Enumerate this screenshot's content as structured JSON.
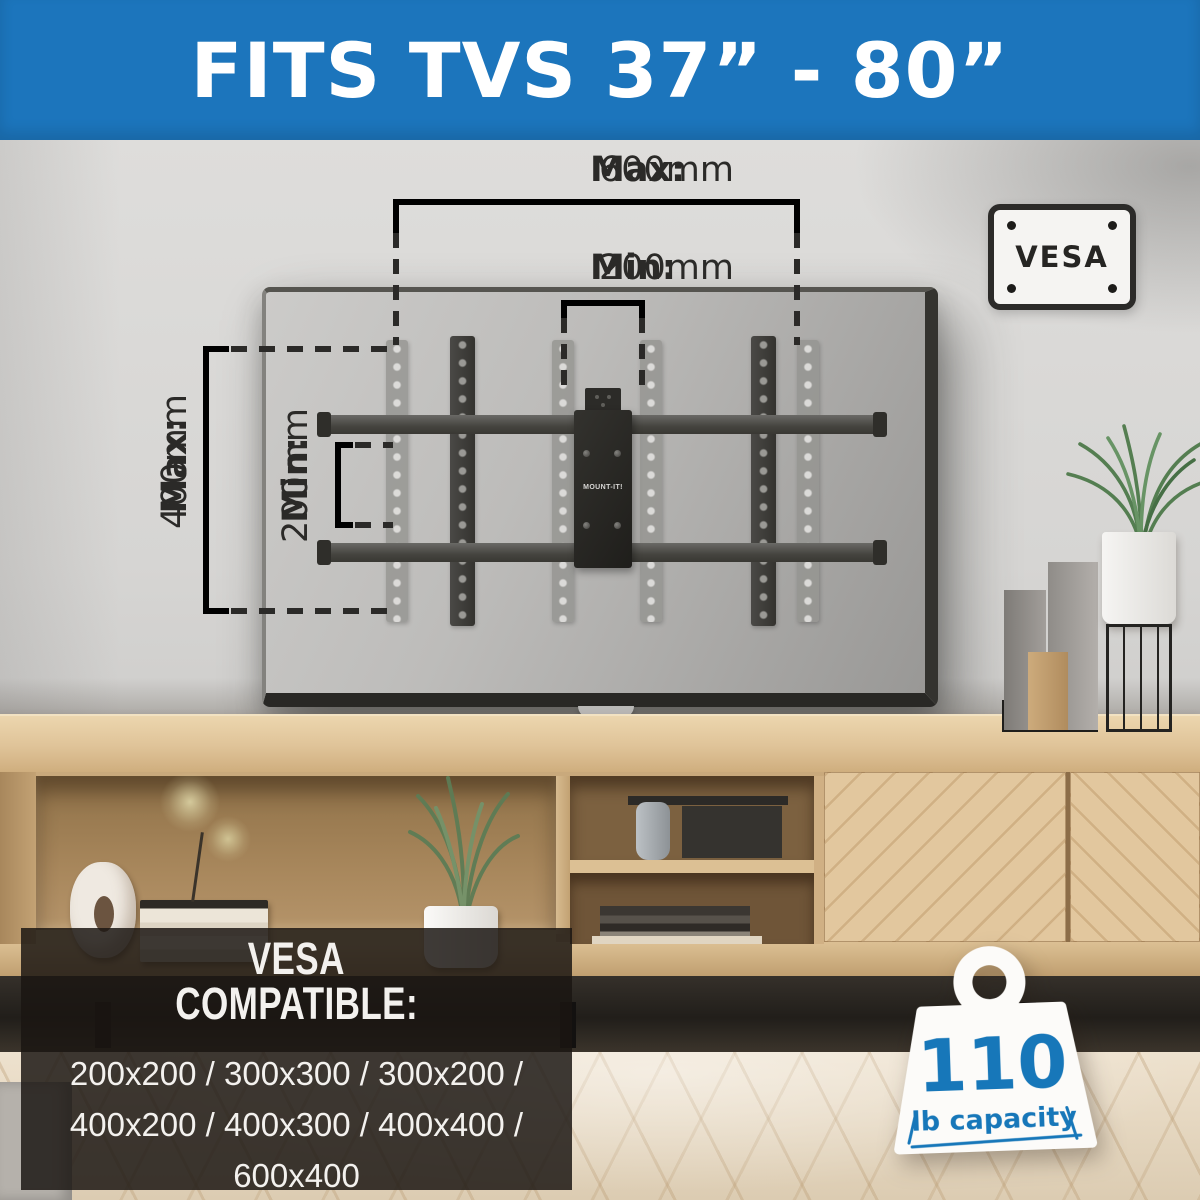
{
  "banner": {
    "title": "FITS TVS 37” - 80”"
  },
  "vesa_badge": {
    "label": "VESA"
  },
  "annotations": {
    "width_max": {
      "label": "Max:",
      "value": "600mm"
    },
    "width_min": {
      "label": "Min:",
      "value": "200mm"
    },
    "height_max": {
      "label": "Max:",
      "value": "400mm"
    },
    "height_min": {
      "label": "Min:",
      "value": "200mm"
    }
  },
  "mount": {
    "brand": "MOUNT-IT!"
  },
  "compatibility": {
    "heading": [
      "VESA",
      "COMPATIBLE:"
    ],
    "lines": [
      "200x200 / 300x300 / 300x200 /",
      "400x200 / 400x300 / 400x400 /",
      "600x400"
    ]
  },
  "capacity": {
    "value": "110",
    "label": "lb capacity"
  },
  "colors": {
    "banner": "#1c75bc",
    "accent": "#1777b9",
    "ink": "#2b2a28"
  }
}
